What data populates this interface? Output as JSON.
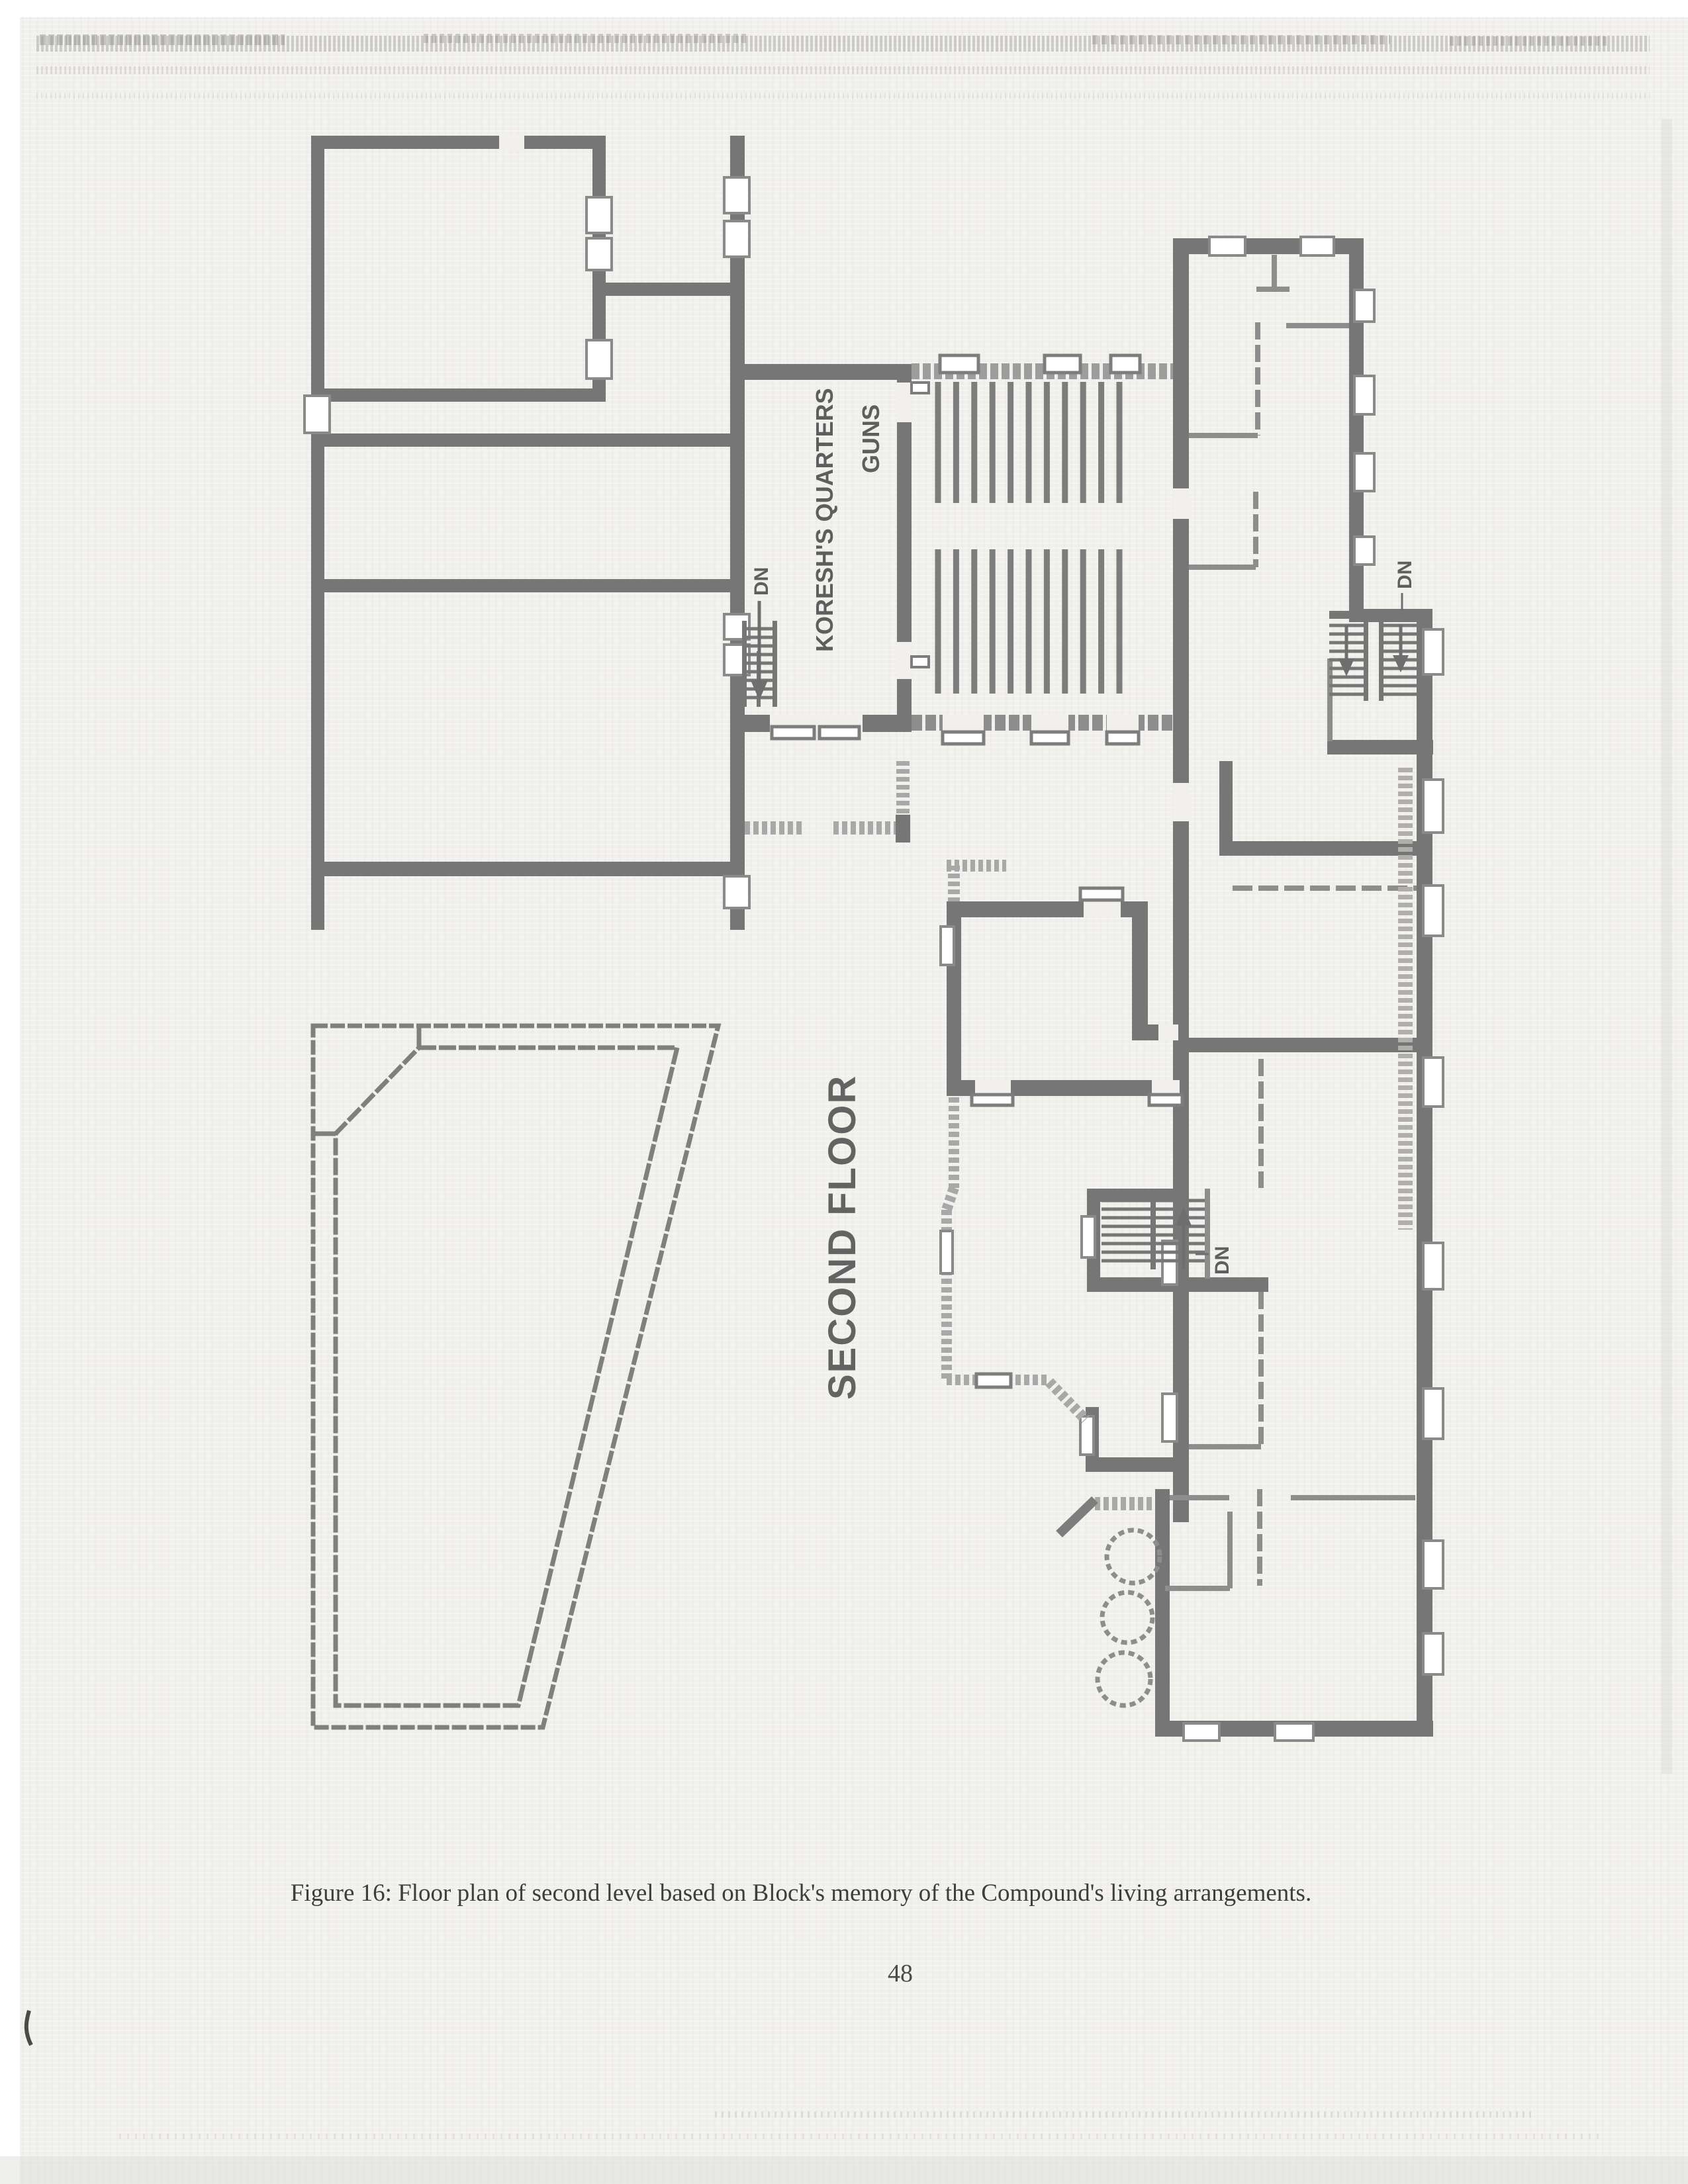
{
  "page": {
    "caption": "Figure 16: Floor plan of second level based on Block's memory of the Compound's living arrangements.",
    "page_number": "48"
  },
  "plan": {
    "title": "SECOND FLOOR",
    "labels": {
      "koresh_quarters": "KORESH'S QUARTERS",
      "guns": "GUNS",
      "dn_left": "DN",
      "dn_right": "DN",
      "dn_middle": "DN"
    },
    "colors": {
      "paper": "#f1f0ec",
      "wall": "#767676",
      "wall_light": "#a8a8a8",
      "partition": "#8d8d8d",
      "pew": "#7d7d7d",
      "label_text": "#5e5e5e",
      "caption_text": "#3d3d3d"
    },
    "features": {
      "pew_blocks": 2,
      "pew_rows_per_block": 11,
      "water_tanks": 3,
      "stairwells": 3,
      "stairwell_marking": "DN"
    }
  }
}
